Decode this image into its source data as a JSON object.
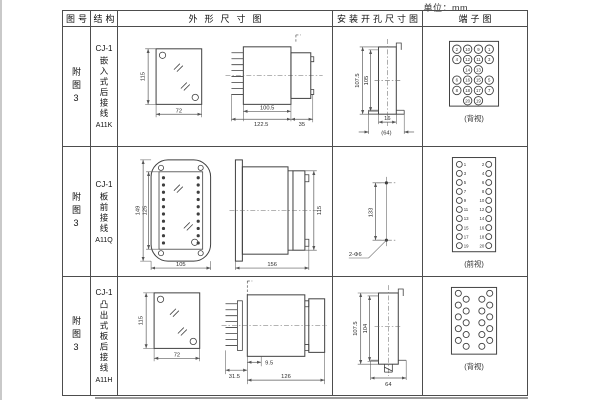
{
  "unit_label": "单位：mm",
  "table_headers": {
    "figure": "图号",
    "structure": "结构",
    "outline": "外形尺寸图",
    "mounting": "安装开孔尺寸图",
    "terminal": "端子图"
  },
  "rows": [
    {
      "figure_no": "附图3",
      "model": "CJ-1",
      "structure": "嵌入式后接线",
      "code": "A11K",
      "outline": {
        "front_h": "115",
        "front_w": "72",
        "body_d": "100.5",
        "total_d": "122.5",
        "rear_d": "35"
      },
      "mounting": {
        "h_outer": "107.5",
        "h_inner": "105",
        "w_slot": "16",
        "w_total": "(64)"
      },
      "terminal": {
        "view": "(背视)",
        "type": "cluster",
        "grid": [
          [
            2,
            10,
            9,
            1
          ],
          [
            4,
            12,
            11,
            3
          ],
          [
            null,
            14,
            13,
            null
          ],
          [
            6,
            16,
            15,
            5
          ],
          [
            8,
            18,
            17,
            7
          ],
          [
            null,
            20,
            19,
            null
          ]
        ]
      }
    },
    {
      "figure_no": "附图3",
      "model": "CJ-1",
      "structure": "板前接线",
      "code": "A11Q",
      "outline": {
        "front_h_outer": "149",
        "front_h_inner": "125",
        "front_w": "105",
        "side_d": "156",
        "side_h": "115"
      },
      "mounting": {
        "hole_dist": "133",
        "holes": "2-Φ6"
      },
      "terminal": {
        "view": "(前视)",
        "type": "dualcol",
        "pairs": [
          [
            1,
            2
          ],
          [
            3,
            4
          ],
          [
            5,
            6
          ],
          [
            7,
            8
          ],
          [
            9,
            10
          ],
          [
            11,
            12
          ],
          [
            13,
            14
          ],
          [
            15,
            16
          ],
          [
            17,
            18
          ],
          [
            19,
            20
          ]
        ]
      }
    },
    {
      "figure_no": "附图3",
      "model": "CJ-1",
      "structure": "凸出式板后接线",
      "code": "A11H",
      "outline": {
        "front_h": "115",
        "front_w": "72",
        "pin_d": "31.5",
        "gap_d": "9.5",
        "body_d": "126"
      },
      "mounting": {
        "h_outer": "107.5",
        "h_inner": "104",
        "w_total": "64"
      },
      "terminal": {
        "view": "(背视)",
        "type": "zigzag",
        "count": 20
      }
    }
  ]
}
